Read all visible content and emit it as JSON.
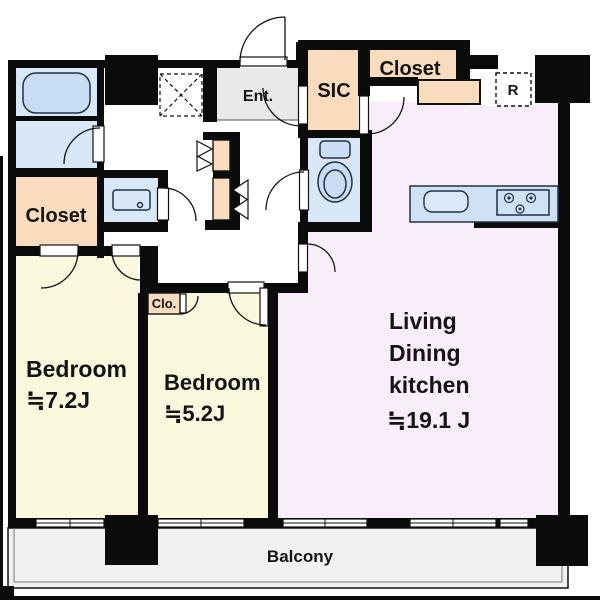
{
  "title": "Apartment floor plan 2LDK",
  "rooms": {
    "bedroom1": {
      "label": "Bedroom",
      "size": "≒7.2J"
    },
    "bedroom2": {
      "label": "Bedroom",
      "size": "≒5.2J"
    },
    "ldk": {
      "label_line1": "Living",
      "label_line2": "Dining",
      "label_line3": "kitchen",
      "size": "≒19.1 J"
    },
    "closet_left": {
      "label": "Closet"
    },
    "closet_top": {
      "label": "Closet"
    },
    "sic": {
      "label": "SIC"
    },
    "entrance": {
      "label": "Ent."
    },
    "clo": {
      "label": "Clo."
    },
    "refrigerator": {
      "label": "R"
    },
    "balcony": {
      "label": "Balcony"
    }
  },
  "colors": {
    "wall": "#0b0b0b",
    "wet_room": "#d9e8f7",
    "fixture_fill": "#c9def4",
    "closet": "#f9dcbd",
    "bedroom": "#fbf9dd",
    "ldk": "#f8eef9",
    "entrance_floor": "#e9e9e9",
    "balcony_floor": "#f1f1f1",
    "counter": "#cfe2f5",
    "outline": "#223040",
    "text": "#141414"
  },
  "icons": {
    "bathtub": "bathtub-icon",
    "washbasin": "washbasin-icon",
    "toilet": "toilet-icon",
    "kitchen_sink": "kitchen-sink-icon",
    "stove_burner": "stove-burner-icon",
    "ceiling_hatch": "ceiling-hatch-icon",
    "door_swing": "door-swing-arc",
    "bifold_door": "bifold-door-icon",
    "window": "sliding-window-icon"
  }
}
